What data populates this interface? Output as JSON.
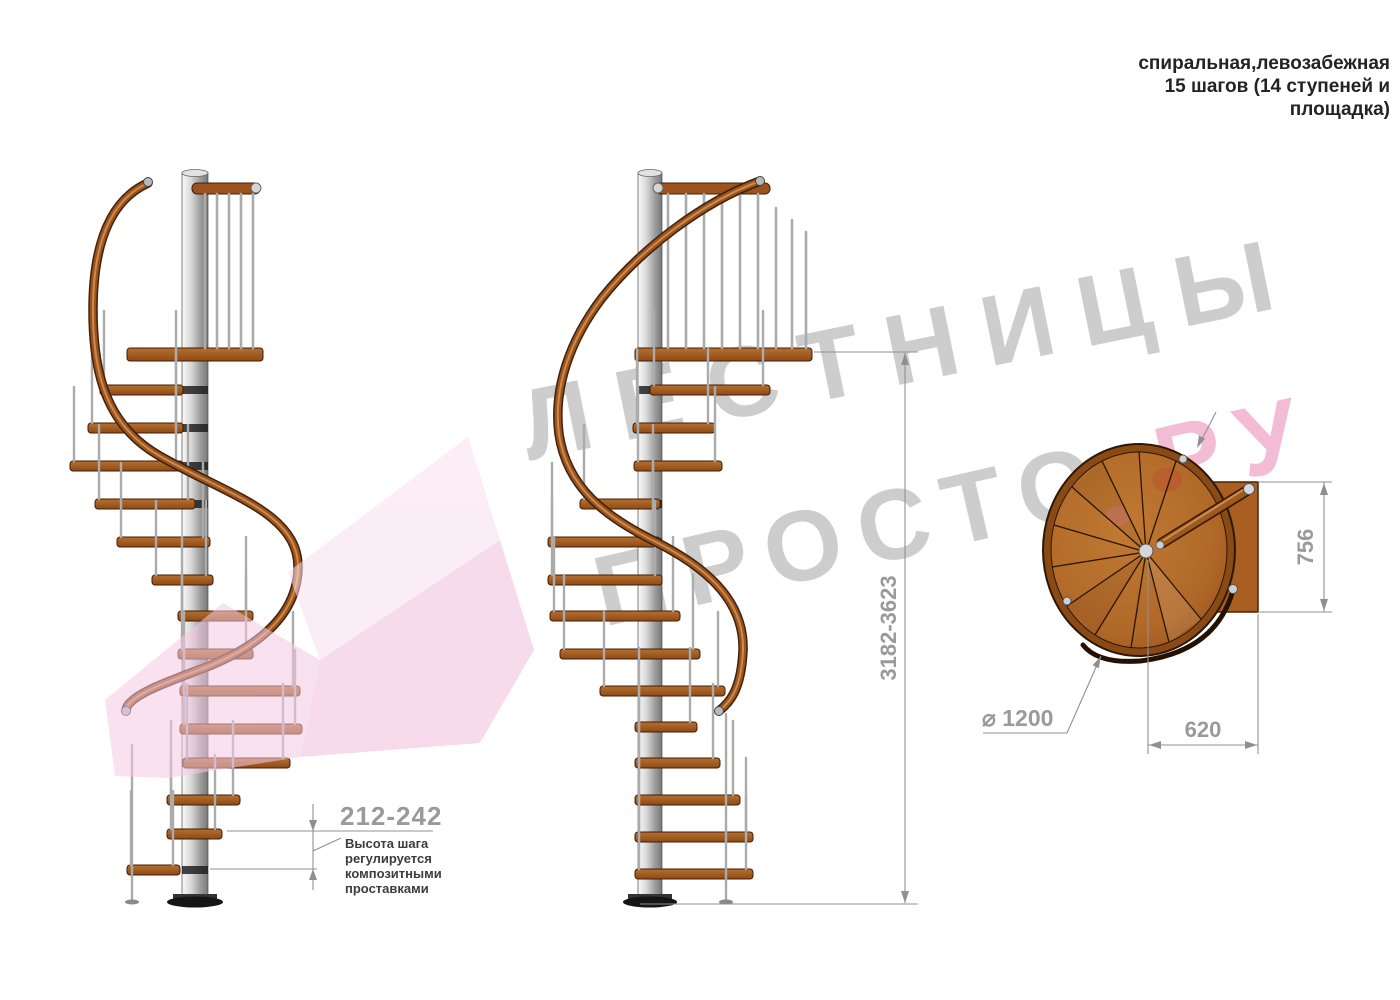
{
  "title": {
    "line1": "спиральная,левозабежная",
    "line2": "15 шагов (14 ступеней и",
    "line3": "площадка)"
  },
  "watermark": {
    "word1": "ЛЕСТНИЦЫ",
    "word2": "ПРОСТО",
    "word3": ".РУ"
  },
  "dimensions": {
    "step_height": "212-242",
    "total_height": "3182-3623",
    "platform_length": "756",
    "platform_width": "620",
    "diameter": "⌀ 1200"
  },
  "note": {
    "line1": "Высота шага",
    "line2": "регулируется",
    "line3": "композитными",
    "line4": "проставками"
  },
  "colors": {
    "wood": "#a2571c",
    "wood_dark": "#3f1d06",
    "metal": "#c9c9c9",
    "dimension_gray": "#9a9a9a",
    "watermark_gray": "#c7c7c7",
    "accent_pink": "#f2c4de"
  }
}
